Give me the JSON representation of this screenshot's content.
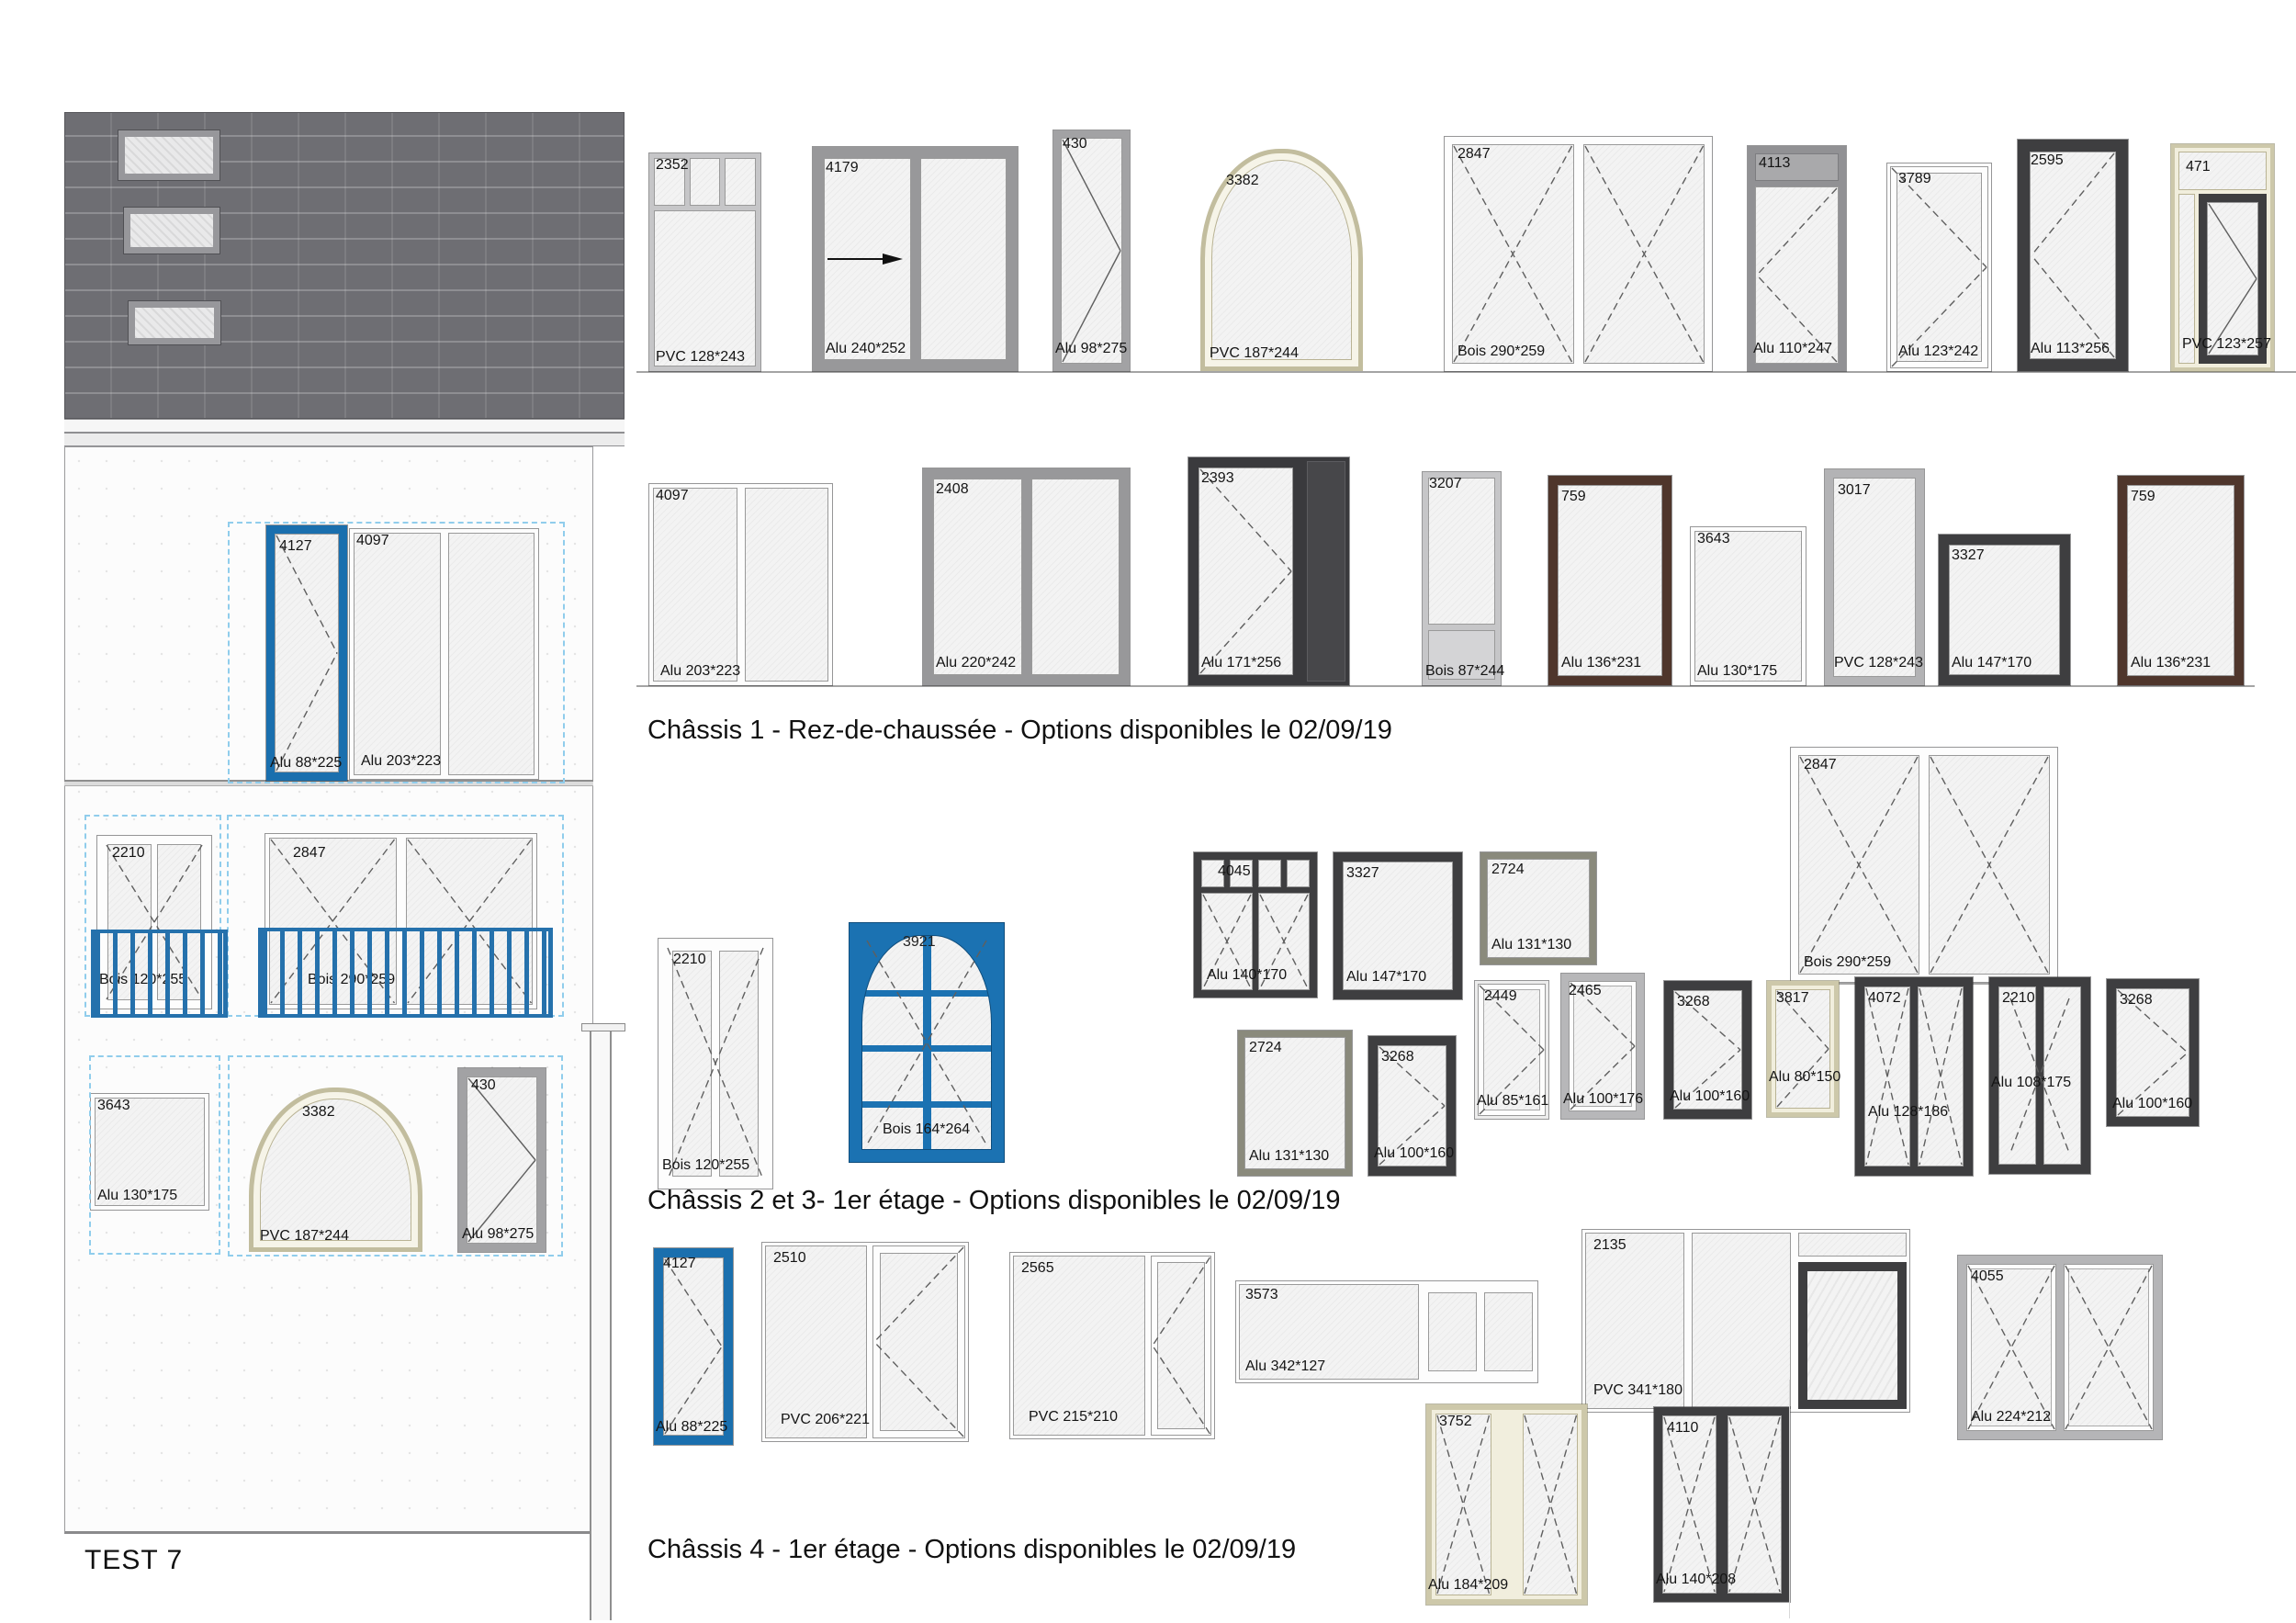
{
  "page": {
    "footer_label": "TEST 7"
  },
  "titles": {
    "section1": "Châssis 1 -  Rez-de-chaussée - Options disponibles le 02/09/19",
    "section2": "Châssis 2 et 3-  1er étage - Options disponibles le 02/09/19",
    "section3": "Châssis 4 -  1er étage - Options disponibles le 02/09/19"
  },
  "colors": {
    "selection_blue": "#1a6fae",
    "railing_blue": "#2571ac",
    "dashed_selection_blue": "#90cdec",
    "charcoal_frame": "#3e3e40",
    "brown_frame": "#4f362c",
    "cream_frame": "#cdc8aa",
    "olive_frame": "#8a8a7c",
    "roof_gray": "#6e6e73"
  },
  "facade": {
    "floor2_door": {
      "id": "4127",
      "dim": "Alu 88*225"
    },
    "floor2_window": {
      "id": "4097",
      "dim": "Alu 203*223"
    },
    "floor1_left": {
      "id": "2210",
      "dim": "Bois 120*255"
    },
    "floor1_right": {
      "id": "2847",
      "dim": "Bois 290*259"
    },
    "floor0_left": {
      "id": "3643",
      "dim": "Alu 130*175"
    },
    "floor0_arch": {
      "id": "3382",
      "dim": "PVC 187*244"
    },
    "floor0_door": {
      "id": "430",
      "dim": "Alu 98*275"
    }
  },
  "row1": {
    "items": [
      {
        "id": "2352",
        "dim": "PVC 128*243"
      },
      {
        "id": "4179",
        "dim": "Alu 240*252"
      },
      {
        "id": "430",
        "dim": "Alu 98*275"
      },
      {
        "id": "3382",
        "dim": "PVC 187*244"
      },
      {
        "id": "2847",
        "dim": "Bois 290*259"
      },
      {
        "id": "4113",
        "dim": "Alu 110*247"
      },
      {
        "id": "3789",
        "dim": "Alu 123*242"
      },
      {
        "id": "2595",
        "dim": "Alu 113*256"
      },
      {
        "id": "471",
        "dim": "PVC 123*257"
      }
    ]
  },
  "row2": {
    "items": [
      {
        "id": "4097",
        "dim": "Alu 203*223"
      },
      {
        "id": "2408",
        "dim": "Alu 220*242"
      },
      {
        "id": "2393",
        "dim": "Alu 171*256"
      },
      {
        "id": "3207",
        "dim": "Bois 87*244"
      },
      {
        "id": "759",
        "dim": "Alu 136*231"
      },
      {
        "id": "3643",
        "dim": "Alu 130*175"
      },
      {
        "id": "3017",
        "dim": "PVC 128*243"
      },
      {
        "id": "3327",
        "dim": "Alu 147*170"
      },
      {
        "id": "759",
        "dim": "Alu 136*231"
      }
    ]
  },
  "row3": {
    "items": [
      {
        "id": "2210",
        "dim": "Bois 120*255"
      },
      {
        "id": "3921",
        "dim": "Bois 164*264"
      },
      {
        "id": "4045",
        "dim": "Alu 140*170"
      },
      {
        "id": "3327",
        "dim": "Alu 147*170"
      },
      {
        "id": "2724",
        "dim": "Alu 131*130"
      },
      {
        "id": "2847",
        "dim": "Bois 290*259"
      },
      {
        "id": "2724",
        "dim": "Alu 131*130"
      },
      {
        "id": "3268",
        "dim": "Alu 100*160"
      },
      {
        "id": "2449",
        "dim": "Alu 85*161"
      },
      {
        "id": "2465",
        "dim": "Alu 100*176"
      },
      {
        "id": "3268",
        "dim": "Alu 100*160"
      },
      {
        "id": "3817",
        "dim": "Alu 80*150"
      },
      {
        "id": "4072",
        "dim": "Alu 128*186"
      },
      {
        "id": "2210",
        "dim": "Alu 108*175"
      },
      {
        "id": "3268",
        "dim": "Alu 100*160"
      }
    ]
  },
  "row4": {
    "items": [
      {
        "id": "4127",
        "dim": "Alu 88*225"
      },
      {
        "id": "2510",
        "dim": "PVC 206*221"
      },
      {
        "id": "2565",
        "dim": "PVC 215*210"
      },
      {
        "id": "3573",
        "dim": "Alu 342*127"
      },
      {
        "id": "2135",
        "dim": "PVC 341*180"
      },
      {
        "id": "4055",
        "dim": "Alu 224*212"
      },
      {
        "id": "3752",
        "dim": "Alu 184*209"
      },
      {
        "id": "4110",
        "dim": "Alu 140*208"
      }
    ]
  }
}
